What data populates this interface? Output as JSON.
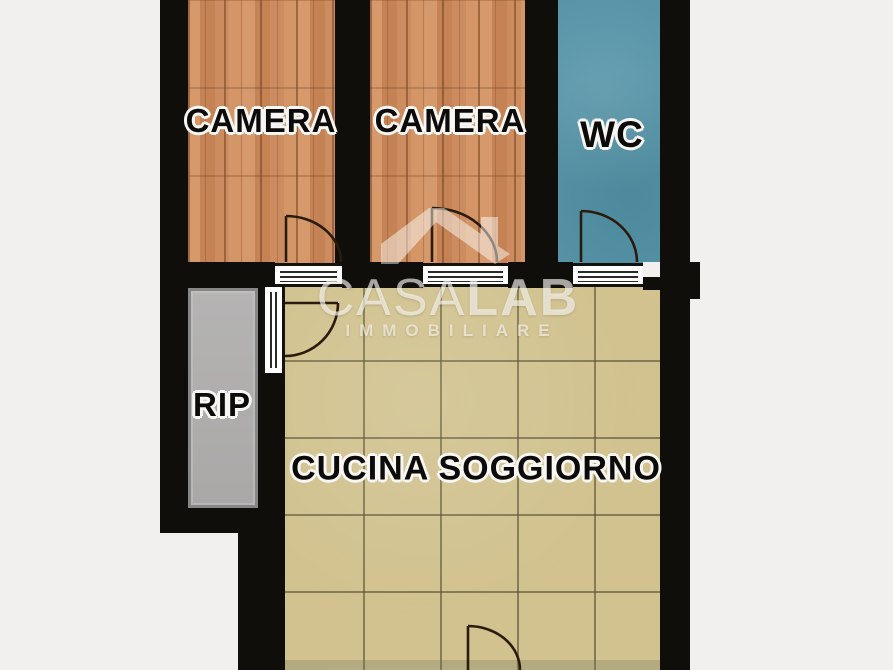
{
  "floorplan": {
    "rooms": {
      "camera1": {
        "label": "CAMERA"
      },
      "camera2": {
        "label": "CAMERA"
      },
      "wc": {
        "label": "WC"
      },
      "rip": {
        "label": "RIP"
      },
      "cucina": {
        "label": "CUCINA SOGGIORNO"
      }
    },
    "watermark": {
      "brand_prefix": "CASA",
      "brand_suffix": "LAB",
      "subtitle": "IMMOBILIARE",
      "logo_icon": "house-roof-icon"
    },
    "colors": {
      "background": "#f1f0ee",
      "wall": "#100e0b",
      "wood_floor": "#ca8b5f",
      "wc_floor": "#5795a8",
      "rip_floor": "#aeadac",
      "kitchen_floor": "#d1c28f",
      "kitchen_grid_line": "#6e6540",
      "watermark_text": "rgba(255,255,255,0.62)"
    }
  }
}
